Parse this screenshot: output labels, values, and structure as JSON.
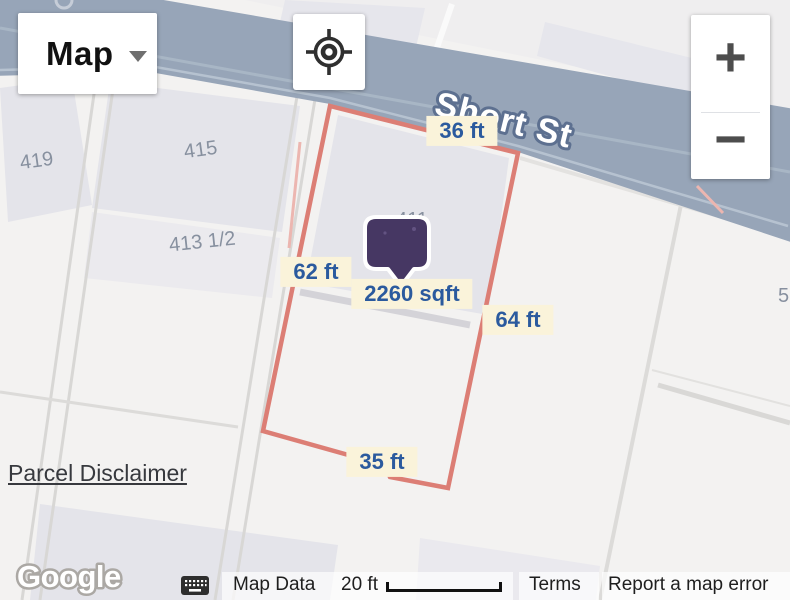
{
  "controls": {
    "map_type_label": "Map",
    "zoom_in_label": "+",
    "zoom_out_label": "−"
  },
  "street": {
    "name": "Short St"
  },
  "parcel": {
    "area_label": "2260 sqft",
    "side_top": "36 ft",
    "side_left": "62 ft",
    "side_right": "64 ft",
    "side_bottom": "35 ft",
    "outline_color": "#dc7e75"
  },
  "house_numbers": [
    {
      "label": "419"
    },
    {
      "label": "415"
    },
    {
      "label": "413 1/2"
    },
    {
      "label": "411"
    },
    {
      "label": "5"
    }
  ],
  "links": {
    "parcel_disclaimer": "Parcel Disclaimer",
    "terms": "Terms",
    "report_error": "Report a map error"
  },
  "attribution": {
    "map_data": "Map Data",
    "scale": "20 ft",
    "google": "Google"
  },
  "colors": {
    "road": "#97a5b8",
    "map_background": "#f3f2f1",
    "building": "#e4e4ea",
    "measure_label_bg": "#faf3da",
    "measure_label_text": "#2b5a9e",
    "marker": "#463763",
    "house_number_text": "#87909f",
    "street_label_halo": "#5d7090"
  }
}
